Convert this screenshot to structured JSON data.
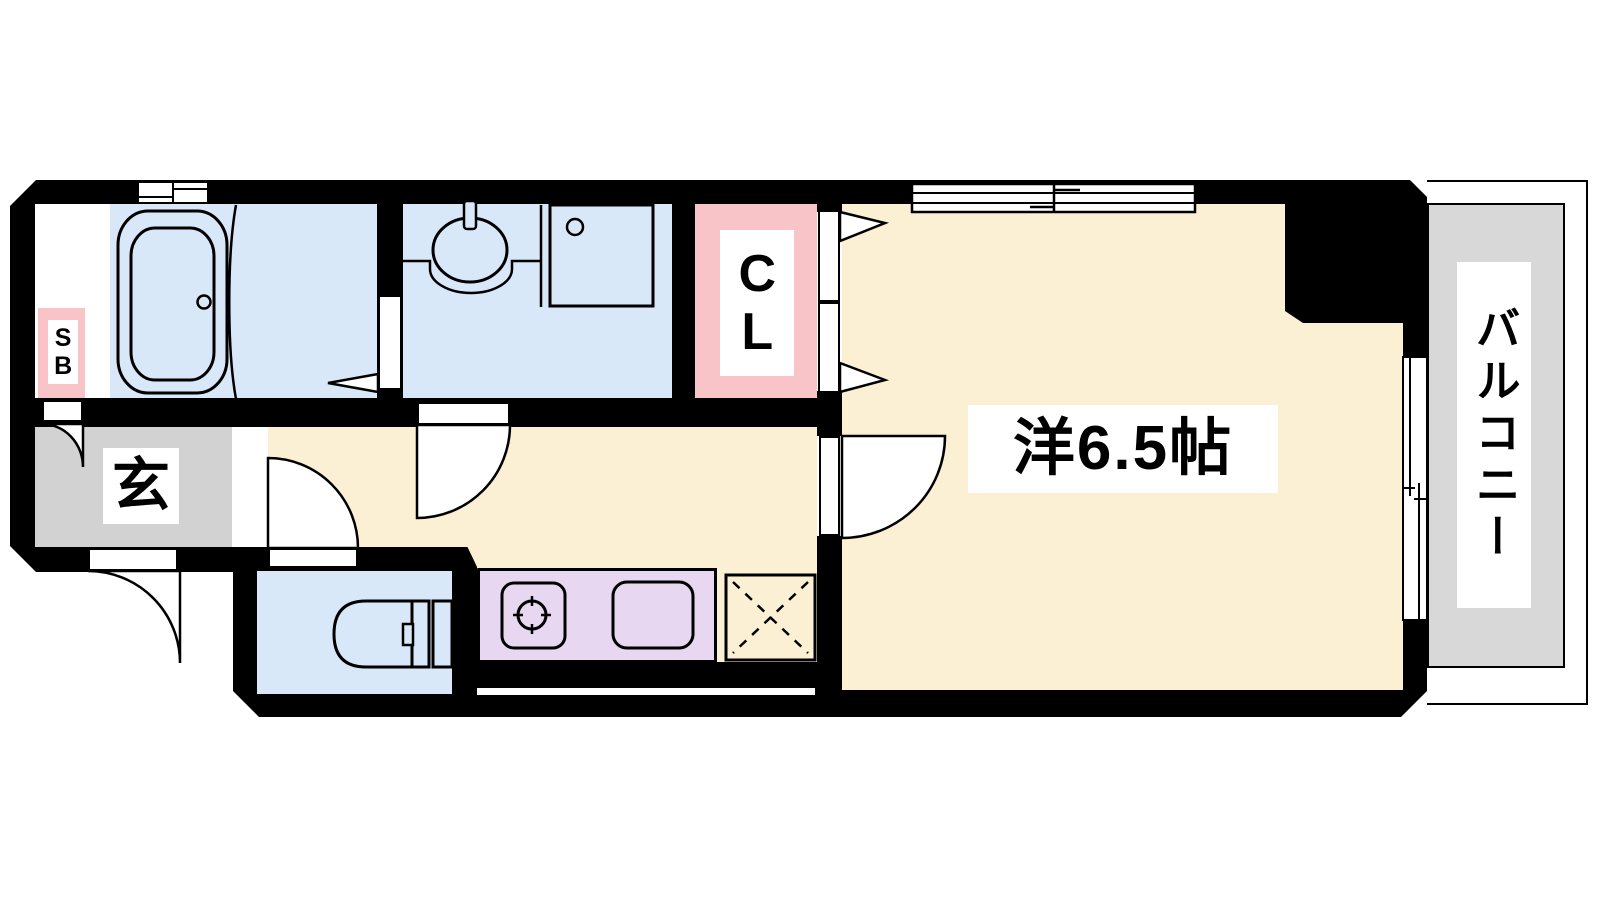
{
  "title": "1K floor plan",
  "rooms": {
    "western": {
      "label": "洋6.5帖"
    },
    "closet": {
      "label": "CL"
    },
    "shoebox": {
      "label": "SB"
    },
    "entrance": {
      "label": "玄"
    },
    "balcony": {
      "label": "バルコニー"
    }
  },
  "colors": {
    "wall": "#000000",
    "wet_area_blue": "#d9e8f8",
    "room_cream": "#fbf0d3",
    "closet_pink": "#f9c4c7",
    "kitchen_purple": "#e8d7f0",
    "entrance_gray": "#d2d2d2",
    "balcony_gray": "#d8d8d8"
  }
}
